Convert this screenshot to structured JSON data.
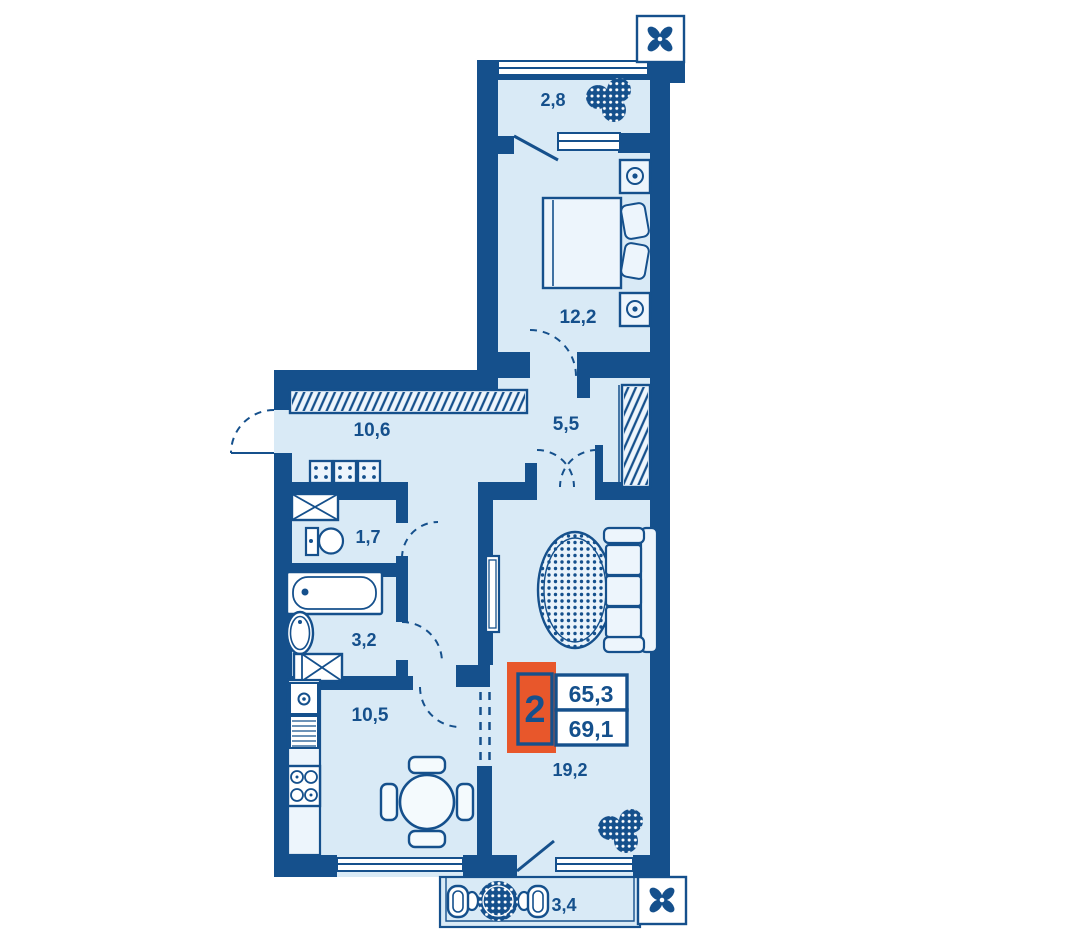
{
  "plan_title": "2-room apartment floor plan",
  "unit": {
    "rooms_count": "2",
    "living_area": "65,3",
    "total_area": "69,1"
  },
  "rooms": {
    "balcony_top": "2,8",
    "bedroom": "12,2",
    "hallway": "10,6",
    "corridor": "5,5",
    "wc": "1,7",
    "bathroom": "3,2",
    "kitchen": "10,5",
    "living_room": "19,2",
    "balcony_bottom": "3,4"
  },
  "icons": {
    "ventilation": "fan-icon",
    "greenery": "plant-icon"
  },
  "colors": {
    "wall": "#15508c",
    "floor": "#d9eaf6",
    "furniture_fill": "#edf5fc",
    "accent_orange": "#e8572b"
  }
}
